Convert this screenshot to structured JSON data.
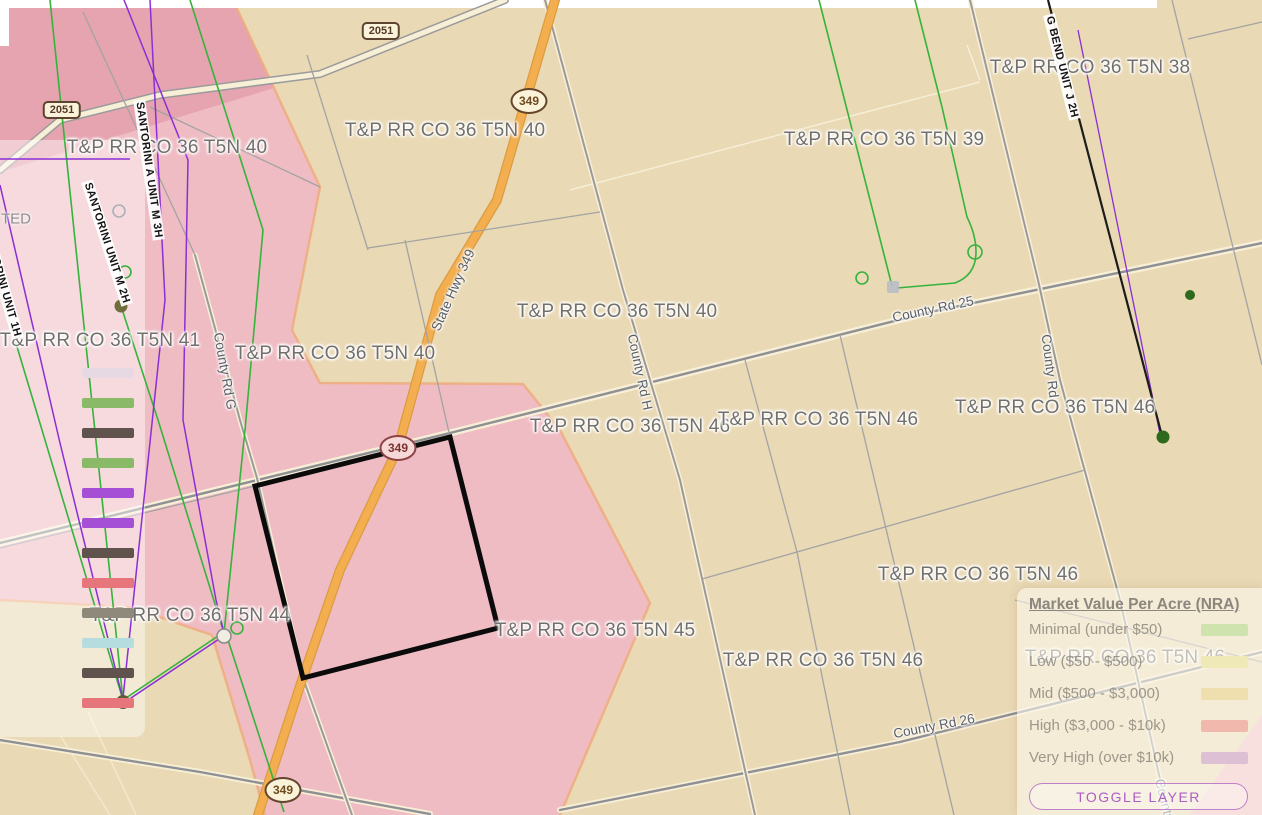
{
  "legend": {
    "title": "Market Value Per Acre (NRA)",
    "items": [
      {
        "label": "Minimal (under $50)",
        "color": "#cfe3ae"
      },
      {
        "label": "Low ($50 - $500)",
        "color": "#eee9b6"
      },
      {
        "label": "Mid ($500 - $3,000)",
        "color": "#efdfae"
      },
      {
        "label": "High ($3,000 - $10k)",
        "color": "#f1b8ad"
      },
      {
        "label": "Very High (over $10k)",
        "color": "#dec0d5"
      }
    ],
    "toggle_button": "TOGGLE LAYER"
  },
  "left_panel": {
    "partial_label": {
      "text": "TED",
      "x": 16,
      "y": 219
    },
    "swatches": [
      {
        "color": "#e7d9e3",
        "x": 108,
        "y": 373
      },
      {
        "color": "#8aba68",
        "x": 108,
        "y": 403
      },
      {
        "color": "#60524c",
        "x": 108,
        "y": 433
      },
      {
        "color": "#8aba68",
        "x": 108,
        "y": 463
      },
      {
        "color": "#a44fd6",
        "x": 108,
        "y": 493
      },
      {
        "color": "#a44fd6",
        "x": 108,
        "y": 523
      },
      {
        "color": "#60524c",
        "x": 108,
        "y": 553
      },
      {
        "color": "#e6757c",
        "x": 108,
        "y": 583
      },
      {
        "color": "#8f897b",
        "x": 108,
        "y": 613
      },
      {
        "color": "#b5dde0",
        "x": 108,
        "y": 643
      },
      {
        "color": "#60524c",
        "x": 108,
        "y": 673
      },
      {
        "color": "#e6757c",
        "x": 108,
        "y": 703
      }
    ]
  },
  "map": {
    "parcel_labels": [
      {
        "text": "T&P RR CO 36 T5N 40",
        "x": 167,
        "y": 148
      },
      {
        "text": "T&P RR CO 36 T5N 40",
        "x": 445,
        "y": 131
      },
      {
        "text": "T&P RR CO 36 T5N 39",
        "x": 884,
        "y": 140
      },
      {
        "text": "T&P RR CO 36 T5N 38",
        "x": 1090,
        "y": 68
      },
      {
        "text": "T&P RR CO 36 T5N 41",
        "x": 100,
        "y": 341
      },
      {
        "text": "T&P RR CO 36 T5N 40",
        "x": 335,
        "y": 354
      },
      {
        "text": "T&P RR CO 36 T5N 40",
        "x": 617,
        "y": 312
      },
      {
        "text": "T&P RR CO 36 T5N 46",
        "x": 630,
        "y": 427
      },
      {
        "text": "T&P RR CO 36 T5N 46",
        "x": 818,
        "y": 420
      },
      {
        "text": "T&P RR CO 36 T5N 46",
        "x": 1055,
        "y": 408
      },
      {
        "text": "T&P RR CO 36 T5N 46",
        "x": 978,
        "y": 575
      },
      {
        "text": "T&P RR CO 36 T5N 44",
        "x": 190,
        "y": 616
      },
      {
        "text": "T&P RR CO 36 T5N 45",
        "x": 595,
        "y": 631
      },
      {
        "text": "T&P RR CO 36 T5N 46",
        "x": 823,
        "y": 661
      },
      {
        "text": "T&P RR CO 36 T5N 46",
        "x": 1125,
        "y": 658
      }
    ],
    "road_labels": [
      {
        "text": "State Hwy 349",
        "x": 453,
        "y": 290,
        "angle": -66
      },
      {
        "text": "County Rd G",
        "x": 225,
        "y": 371,
        "angle": 80
      },
      {
        "text": "County Rd H",
        "x": 640,
        "y": 372,
        "angle": 78
      },
      {
        "text": "County Rd 25",
        "x": 933,
        "y": 309,
        "angle": -12
      },
      {
        "text": "County Rd",
        "x": 1050,
        "y": 366,
        "angle": 83
      },
      {
        "text": "County Rd 26",
        "x": 934,
        "y": 726,
        "angle": -11
      },
      {
        "text": "County Rd",
        "x": 1167,
        "y": 810,
        "angle": 76
      }
    ],
    "well_labels": [
      {
        "text": "SANTORINI A UNIT M 3H",
        "x": 149,
        "y": 170,
        "angle": 82
      },
      {
        "text": "SANTORINI UNIT M 2H",
        "x": 107,
        "y": 243,
        "angle": 72
      },
      {
        "text": "SANTORINI UNIT 1H",
        "x": 2,
        "y": 282,
        "angle": 74
      },
      {
        "text": "G BEND UNIT J 2H",
        "x": 1062,
        "y": 67,
        "angle": 76
      }
    ],
    "shields": [
      {
        "text": "2051",
        "x": 62,
        "y": 110,
        "cls": "rshield"
      },
      {
        "text": "2051",
        "x": 381,
        "y": 31,
        "cls": "rshield"
      },
      {
        "text": "349",
        "x": 529,
        "y": 101,
        "cls": "eshield"
      },
      {
        "text": "349",
        "x": 398,
        "y": 448,
        "cls": "eshield pinkish"
      },
      {
        "text": "349",
        "x": 283,
        "y": 790,
        "cls": "eshield"
      }
    ]
  },
  "colors": {
    "map_base": "#ead9b5",
    "overlay_pink": "#efbcc4",
    "overlay_dark_pink": "#e6a4b0",
    "overlay_edge_orange": "#eeab7d",
    "highway_orange": "#f3ae50",
    "well_line_green": "#35b33c",
    "well_line_purple": "#8a2fd6",
    "selection_outline": "#0b0b0b"
  }
}
